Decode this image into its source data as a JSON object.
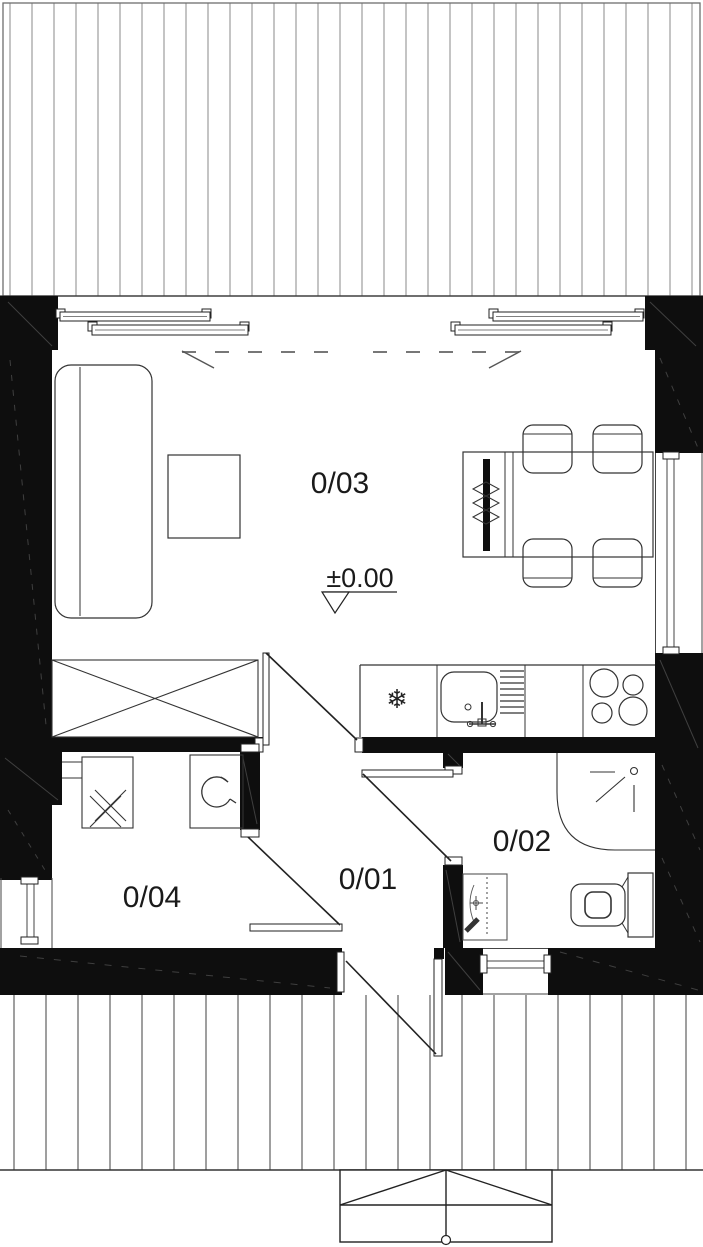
{
  "title": "Floor plan",
  "rooms": {
    "living": "0/03",
    "hall": "0/01",
    "bath": "0/02",
    "utility": "0/04"
  },
  "annotations": {
    "level": "±0.00"
  },
  "icons": {
    "freezer": "❄"
  },
  "colors": {
    "wall": "#0e0e0e",
    "line": "#222222",
    "deck_line_top": "#8a8a8a",
    "deck_line_bottom": "#5f5f5f"
  }
}
